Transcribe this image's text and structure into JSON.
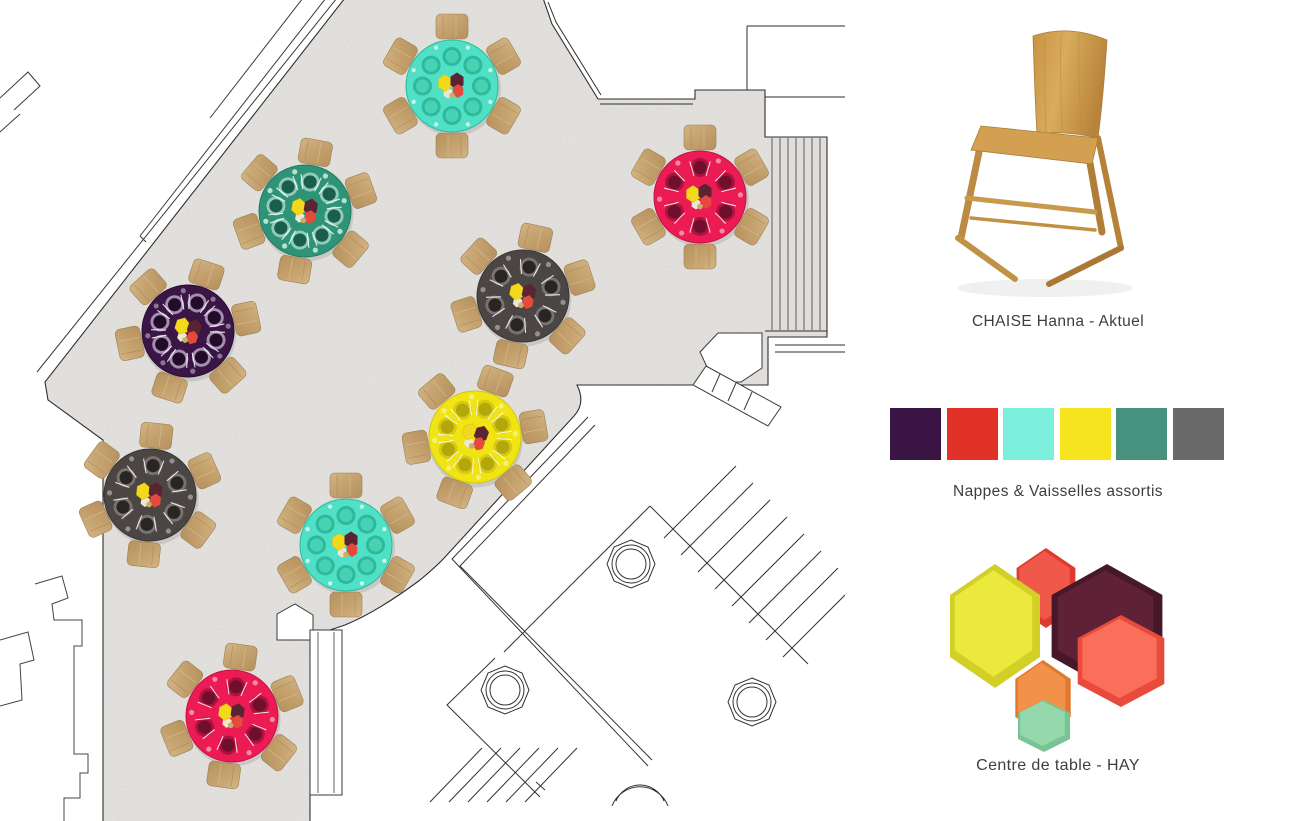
{
  "panel": {
    "chair": {
      "label": "CHAISE Hanna - Aktuel"
    },
    "palette": {
      "label": "Nappes & Vaisselles assortis",
      "colors": [
        "#3A1544",
        "#E23227",
        "#7CEEDC",
        "#F5E41E",
        "#47917F",
        "#6A6A6A"
      ]
    },
    "centerpiece": {
      "label": "Centre de table - HAY",
      "trays": [
        {
          "name": "red-small",
          "cx": 116,
          "cy": 40,
          "rx": 34,
          "ry": 40,
          "fill": "#F0584A",
          "rim": "#DE3B2E"
        },
        {
          "name": "yellow",
          "cx": 65,
          "cy": 78,
          "rx": 52,
          "ry": 62,
          "fill": "#EBE83E",
          "rim": "#D2CF27"
        },
        {
          "name": "orange",
          "cx": 113,
          "cy": 150,
          "rx": 32,
          "ry": 38,
          "fill": "#F29249",
          "rim": "#E07830"
        },
        {
          "name": "mint",
          "cx": 114,
          "cy": 178,
          "rx": 30,
          "ry": 26,
          "fill": "#94D8AC",
          "rim": "#79C394"
        },
        {
          "name": "burgundy",
          "cx": 177,
          "cy": 78,
          "rx": 64,
          "ry": 62,
          "fill": "#5E2135",
          "rim": "#471829"
        },
        {
          "name": "coral",
          "cx": 191,
          "cy": 113,
          "rx": 50,
          "ry": 46,
          "fill": "#FA6E5A",
          "rim": "#E84B3C"
        }
      ]
    }
  },
  "floorplan": {
    "tables": [
      {
        "x": 452,
        "y": 86,
        "style": "turquoise",
        "rot": 0
      },
      {
        "x": 305,
        "y": 211,
        "style": "green",
        "rot": 10
      },
      {
        "x": 700,
        "y": 197,
        "style": "crimson",
        "rot": 0
      },
      {
        "x": 188,
        "y": 331,
        "style": "purple",
        "rot": 18
      },
      {
        "x": 523,
        "y": 296,
        "style": "darkgray",
        "rot": 12
      },
      {
        "x": 475,
        "y": 437,
        "style": "yellow",
        "rot": 20
      },
      {
        "x": 150,
        "y": 495,
        "style": "darkgray",
        "rot": 6
      },
      {
        "x": 346,
        "y": 545,
        "style": "turquoise",
        "rot": 0
      },
      {
        "x": 232,
        "y": 716,
        "style": "crimson",
        "rot": 8
      }
    ],
    "table_styles": {
      "turquoise": {
        "top": "#4FE0C5",
        "edge": "#2CBAA0",
        "ring": "#2EB89C",
        "plate": "#48D2B4",
        "glass": "#D8FBF2",
        "plates": 8,
        "cutlery": false
      },
      "green": {
        "top": "#2F9377",
        "edge": "#217A61",
        "ring": "#8FCDBA",
        "plate": "#1A5F4C",
        "glass": "#BFE6D8",
        "plates": 8,
        "cutlery": true
      },
      "crimson": {
        "top": "#EC1B53",
        "edge": "#C41245",
        "ring": "#AD1240",
        "plate": "#700F2C",
        "glass": "#F590AB",
        "plates": 6,
        "cutlery": true
      },
      "purple": {
        "top": "#3A1545",
        "edge": "#2A0F33",
        "ring": "#A48FB0",
        "plate": "#220C29",
        "glass": "#8F7A9A",
        "plates": 8,
        "cutlery": true
      },
      "darkgray": {
        "top": "#4B4644",
        "edge": "#393534",
        "ring": "#787370",
        "plate": "#282523",
        "glass": "#979390",
        "plates": 6,
        "cutlery": true
      },
      "yellow": {
        "top": "#F0E414",
        "edge": "#D2C60F",
        "ring": "#D8CA10",
        "plate": "#B3A70C",
        "glass": "#F7F07A",
        "plates": 8,
        "cutlery": true
      }
    },
    "centerpiece_colors": {
      "hex_yellow": "#F2D91C",
      "hex_maroon": "#5A2433",
      "hex_red": "#E64A3C",
      "hex_cream": "#EFE6D2",
      "dot": "#C9AE6B"
    },
    "chair_wood": {
      "light": "#D4B484",
      "dark": "#B6915E",
      "stroke": "#9B8055"
    }
  }
}
